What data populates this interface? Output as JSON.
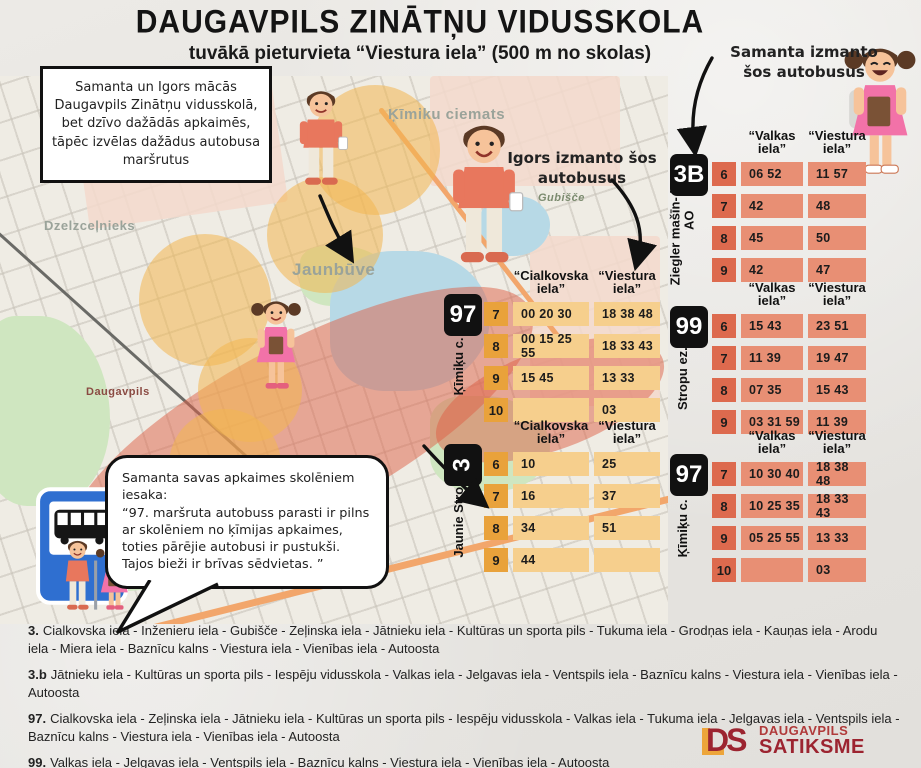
{
  "header": {
    "title": "DAUGAVPILS ZINĀTŅU VIDUSSKOLA",
    "subtitle": "tuvākā pieturvieta “Viestura iela” (500 m no skolas)"
  },
  "intro_box": "Samanta un Igors mācās Daugavpils Zinātņu vidusskolā, bet dzīvo dažādās apkaimēs, tāpēc izvēlas dažādus autobusa maršrutus",
  "igors_label": "Igors izmanto šos autobusus",
  "samanta_label": "Samanta izmanto šos autobusus",
  "speech_bubble": {
    "line1": "Samanta savas apkaimes skolēniem iesaka:",
    "line2": "“97. maršruta autobuss parasti ir pilns ar skolēniem no ķīmijas apkaimes, toties pārējie autobusi ir pustukši. Tajos bieži ir brīvas sēdvietas. ”"
  },
  "map": {
    "label_kimiku": "Ķīmiku ciemats",
    "label_jaunbuve": "Jaunbūve",
    "label_dzelzcelnieks": "Dzelzceļnieks",
    "label_daugavpils": "Daugavpils",
    "label_gubisce": "Gubišče"
  },
  "tables": {
    "y97": {
      "route": "97",
      "side": "Ķīmiķu c. - AO",
      "col1": "“Cialkovska iela”",
      "col2": "“Viestura iela”",
      "rows": [
        {
          "h": "7",
          "c1": "00 20 30",
          "c2": "18 38 48"
        },
        {
          "h": "8",
          "c1": "00 15 25 55",
          "c2": "18 33 43"
        },
        {
          "h": "9",
          "c1": "15 45",
          "c2": "13 33"
        },
        {
          "h": "10",
          "c1": "",
          "c2": "03"
        }
      ]
    },
    "y3": {
      "route": "3",
      "side": "Jaunie Stropi - AO",
      "col1": "“Cialkovska iela”",
      "col2": "“Viestura iela”",
      "rows": [
        {
          "h": "6",
          "c1": "10",
          "c2": "25"
        },
        {
          "h": "7",
          "c1": "16",
          "c2": "37"
        },
        {
          "h": "8",
          "c1": "34",
          "c2": "51"
        },
        {
          "h": "9",
          "c1": "44",
          "c2": ""
        }
      ]
    },
    "r3b": {
      "route": "3B",
      "side": "Ziegler mašīn- būve - AO",
      "col1": "“Valkas iela”",
      "col2": "“Viestura iela”",
      "rows": [
        {
          "h": "6",
          "c1": "06 52",
          "c2": "11 57"
        },
        {
          "h": "7",
          "c1": "42",
          "c2": "48"
        },
        {
          "h": "8",
          "c1": "45",
          "c2": "50"
        },
        {
          "h": "9",
          "c1": "42",
          "c2": "47"
        }
      ]
    },
    "r99": {
      "route": "99",
      "side": "Stropu ez.- AO",
      "col1": "“Valkas iela”",
      "col2": "“Viestura iela”",
      "rows": [
        {
          "h": "6",
          "c1": "15 43",
          "c2": "23 51"
        },
        {
          "h": "7",
          "c1": "11 39",
          "c2": "19 47"
        },
        {
          "h": "8",
          "c1": "07 35",
          "c2": "15 43"
        },
        {
          "h": "9",
          "c1": "03 31 59",
          "c2": "11 39"
        }
      ]
    },
    "r97": {
      "route": "97",
      "side": "Ķīmiķu c. - AO",
      "col1": "“Valkas iela”",
      "col2": "“Viestura iela”",
      "rows": [
        {
          "h": "7",
          "c1": "10 30 40",
          "c2": "18 38 48"
        },
        {
          "h": "8",
          "c1": "10 25 35",
          "c2": "18 33 43"
        },
        {
          "h": "9",
          "c1": "05 25 55",
          "c2": "13 33"
        },
        {
          "h": "10",
          "c1": "",
          "c2": "03"
        }
      ]
    }
  },
  "route_notes": [
    {
      "number": "3.",
      "text": "Cialkovska iela - Inženieru iela - Gubišče - Zeļinska iela - Jātnieku iela - Kultūras un sporta pils - Tukuma iela - Grodņas iela - Kauņas iela - Arodu iela - Miera iela - Baznīcu kalns - Viestura iela - Vienības iela - Autoosta"
    },
    {
      "number": "3.b",
      "text": "Jātnieku iela - Kultūras un sporta pils - Iespēju vidusskola - Valkas iela - Jelgavas iela - Ventspils iela - Baznīcu kalns - Viestura iela - Vienības iela - Autoosta"
    },
    {
      "number": "97.",
      "text": "Cialkovska iela - Zeļinska iela - Jātnieku iela - Kultūras un sporta pils - Iespēju vidusskola - Valkas iela - Tukuma iela - Jelgavas iela - Ventspils iela - Baznīcu kalns - Viestura iela - Vienības iela - Autoosta"
    },
    {
      "number": "99.",
      "text": "Valkas iela - Jelgavas iela - Ventspils iela - Baznīcu kalns - Viestura iela - Vienības iela - Autoosta"
    }
  ],
  "logo": {
    "monogram": "DS",
    "line1": "DAUGAVPILS",
    "line2": "SATIKSME"
  },
  "colors": {
    "yellow_hour": "#e9a23b",
    "yellow_cell": "#f6cf8d",
    "red_hour": "#dd6a4e",
    "red_cell": "#e88f74",
    "badge": "#111111",
    "logo_red": "#9c2430",
    "logo_yellow": "#eda53a",
    "sign_blue": "#2f6fd0",
    "zone_red": "rgba(222,95,70,0.5)",
    "zone_yellow": "rgba(242,183,80,0.55)"
  }
}
